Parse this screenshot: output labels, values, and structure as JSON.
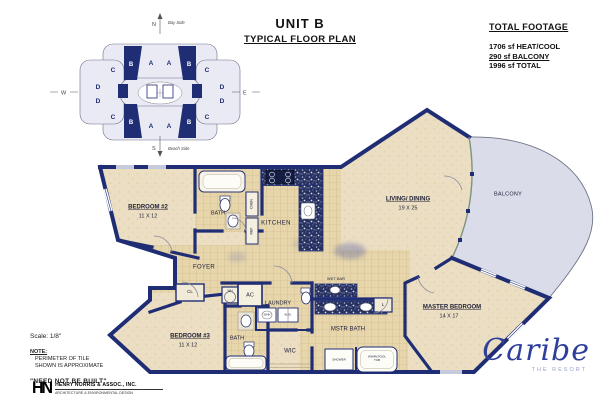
{
  "title": {
    "unit": "UNIT  B",
    "subtitle": "TYPICAL FLOOR PLAN"
  },
  "total_footage": {
    "heading": "TOTAL FOOTAGE",
    "lines": [
      {
        "text": "1706 sf HEAT/COOL"
      },
      {
        "text": "290 sf BALCONY"
      },
      {
        "text": "1996 sf TOTAL"
      }
    ]
  },
  "key_plan": {
    "compass": {
      "north": "N",
      "south": "S",
      "west": "W",
      "east": "E"
    },
    "north_note": "Bay Side",
    "south_note": "Beach Side",
    "letters": {
      "a": "A",
      "b": "B",
      "c": "C",
      "d": "D"
    }
  },
  "rooms": {
    "bedroom2": {
      "name": "BEDROOM #2",
      "dims": "11 X 12"
    },
    "bath2": {
      "name": "BATH"
    },
    "kitchen": {
      "name": "KITCHEN"
    },
    "living": {
      "name": "LIVING/ DINING",
      "dims": "19 X 25"
    },
    "balcony": {
      "name": "BALCONY"
    },
    "foyer": {
      "name": "FOYER"
    },
    "laundry": {
      "name": "LAUNDRY"
    },
    "wet_bar": {
      "name": "WET BAR"
    },
    "mstr_bath": {
      "name": "MSTR BATH"
    },
    "master": {
      "name": "MASTER BEDROOM",
      "dims": "14 X 17"
    },
    "bedroom3": {
      "name": "BEDROOM #3",
      "dims": "11 X 12"
    },
    "bath3": {
      "name": "BATH"
    },
    "wic": {
      "name": "WIC"
    }
  },
  "fixtures": {
    "oven": "OVEN",
    "ref": "REF",
    "sink": "SINK",
    "washer_dryer": "W./D.",
    "water_heater": "WH",
    "ac": "AC",
    "closet": "CL",
    "linen": "L",
    "shower": "SHOWER",
    "whirlpool": "WHIRLPOOL TUB"
  },
  "notes": {
    "scale": "Scale: 1/8\"",
    "note_heading": "NOTE:",
    "note_line1": "PERIMETER OF TILE",
    "note_line2": "SHOWN IS APPROXIMATE",
    "disclaimer": "\"NEED NOT BE BUILT\""
  },
  "architect": {
    "monogram": "HN",
    "name": "HENRY NORRIS & ASSOC., INC.",
    "tagline": "ARCHITECTURE & ENVIRONMENTAL DESIGN"
  },
  "brand": {
    "name": "Caribe",
    "subtitle": "THE RESORT"
  },
  "colors": {
    "wall_navy": "#1f2d74",
    "floor_tan": "#ebdec2",
    "tile_tan": "#e7d6ab",
    "balcony_lavender": "#dbdcea",
    "keyplan_fill": "#eaeaf5",
    "brand_blue": "#2e3f9d"
  }
}
